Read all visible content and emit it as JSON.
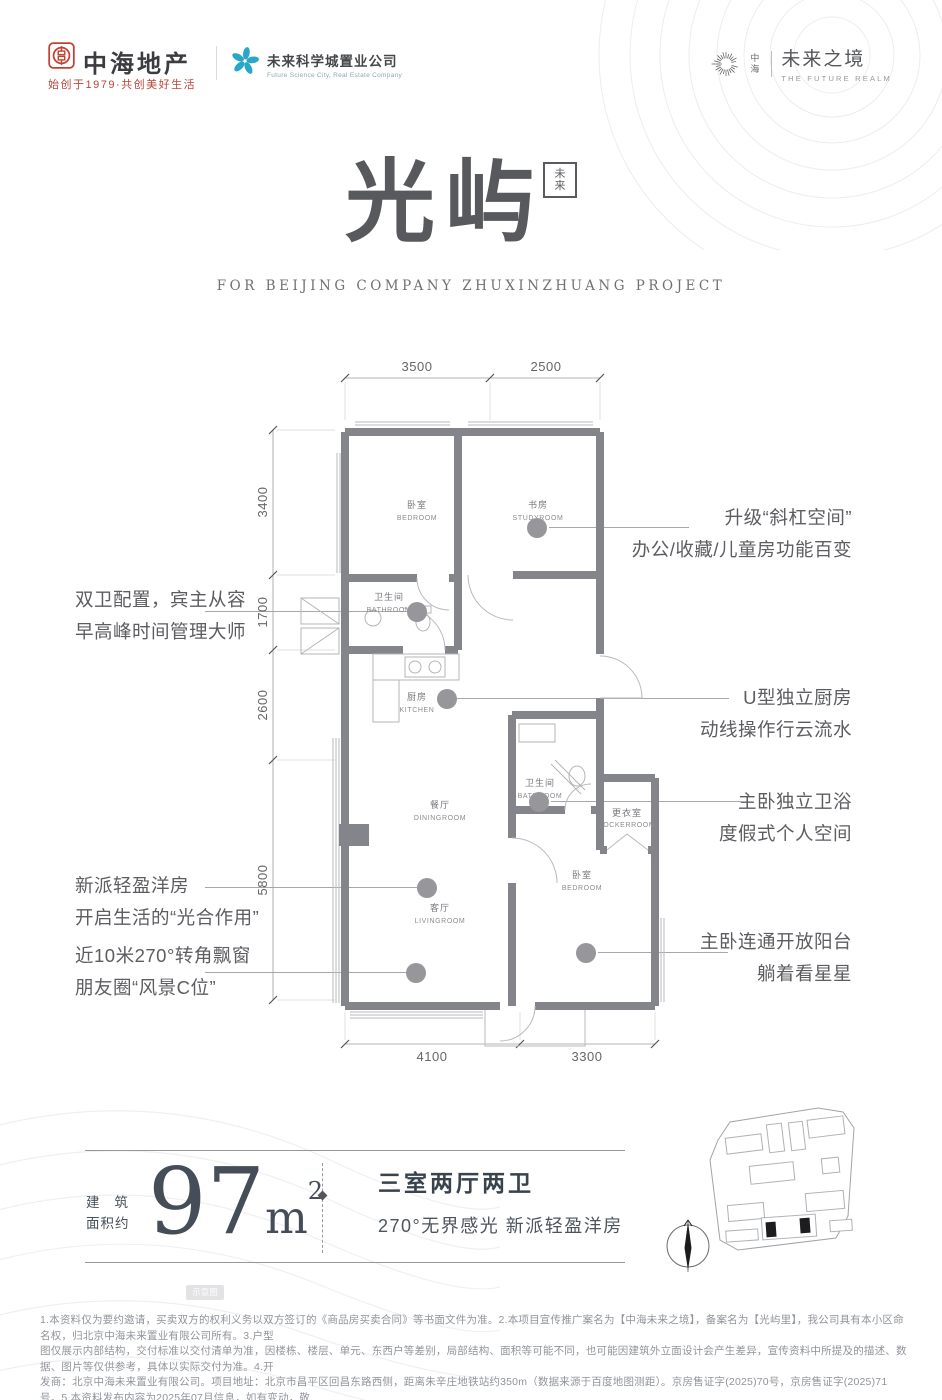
{
  "brand": {
    "zhonghai_name": "中海地产",
    "zhonghai_tagline": "始创于1979·共创美好生活",
    "fsc_name": "未来科学城置业公司",
    "fsc_sub": "Future Science City, Real Estate Company",
    "realm_mini": "中海",
    "realm_name": "未来之境",
    "realm_sub": "THE FUTURE REALM"
  },
  "title": {
    "main": "光屿",
    "seal": "未来",
    "subtitle": "FOR BEIJING COMPANY ZHUXINZHUANG PROJECT"
  },
  "plan": {
    "dim_top_1": "3500",
    "dim_top_2": "2500",
    "dim_left_1": "3400",
    "dim_left_2": "1700",
    "dim_left_3": "2600",
    "dim_left_4": "5800",
    "dim_bottom_1": "4100",
    "dim_bottom_2": "3300",
    "rooms": {
      "bedroom1_cn": "卧室",
      "bedroom1_en": "BEDROOM",
      "study_cn": "书房",
      "study_en": "STUDYROOM",
      "bath1_cn": "卫生间",
      "bath1_en": "BATHROOM",
      "kitchen_cn": "厨房",
      "kitchen_en": "KITCHEN",
      "dining_cn": "餐厅",
      "dining_en": "DININGROOM",
      "living_cn": "客厅",
      "living_en": "LIVINGROOM",
      "bath2_cn": "卫生间",
      "bath2_en": "BATHROOM",
      "locker_cn": "更衣室",
      "locker_en": "LOCKERROOM",
      "bedroom2_cn": "卧室",
      "bedroom2_en": "BEDROOM"
    }
  },
  "callouts": {
    "left1_a": "双卫配置，宾主从容",
    "left1_b": "早高峰时间管理大师",
    "left2_a": "新派轻盈洋房",
    "left2_b": "开启生活的“光合作用”",
    "left3_a": "近10米270°转角飘窗",
    "left3_b": "朋友圈“风景C位”",
    "right1_a": "升级“斜杠空间”",
    "right1_b": "办公/收藏/儿童房功能百变",
    "right2_a": "U型独立厨房",
    "right2_b": "动线操作行云流水",
    "right3_a": "主卧独立卫浴",
    "right3_b": "度假式个人空间",
    "right4_a": "主卧连通开放阳台",
    "right4_b": "躺着看星星"
  },
  "info": {
    "area_label_1": "建筑",
    "area_label_2": "面积约",
    "area_value": "97",
    "area_unit": "m",
    "area_sup": "2",
    "layout": "三室两厅两卫",
    "features": "270°无界感光 新派轻盈洋房"
  },
  "badge": "示意图",
  "disclaimer": {
    "line1": "1.本资料仅为要约邀请，买卖双方的权利义务以双方签订的《商品房买卖合同》等书面文件为准。2.本项目宣传推广案名为【中海未来之境】，备案名为【光屿里】，我公司具有本小区命名权，归北京中海未来置业有限公司所有。3.户型",
    "line2": "图仅展示内部结构，交付标准以交付清单为准，因楼栋、楼层、单元、东西户等差别，局部结构、面积等可能不同，也可能因建筑外立面设计会产生差异，宣传资料中所提及的描述、数据、图片等仅供参考，具体以实际交付为准。4.开",
    "line3": "发商：北京中海未来置业有限公司。项目地址：北京市昌平区回昌东路西侧，距离朱辛庄地铁站约350m（数据来源于百度地图测距）。京房售证字(2025)70号，京房售证字(2025)71号。5.本资料发布内容为2025年07月信息，如有变动，敬",
    "line4": "请留意最新资料。"
  },
  "colors": {
    "brand_red": "#b5483a",
    "brand_teal": "#2aa7c8",
    "wall_gray": "#84858b",
    "ink": "#55565a"
  }
}
